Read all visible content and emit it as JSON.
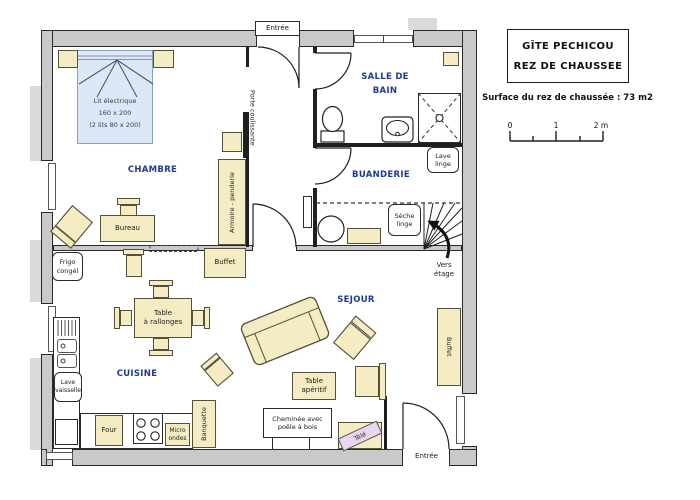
{
  "title_block": {
    "line1": "GÎTE PECHICOU",
    "line2": "REZ DE CHAUSSEE"
  },
  "surface_note": "Surface du rez de chaussée : 73 m2",
  "scale_bar": {
    "t0": "0",
    "t1": "1",
    "t2": "2 m"
  },
  "rooms": {
    "chambre": "CHAMBRE",
    "salle_de_bain": "SALLE DE\nBAIN",
    "buanderie": "BUANDERIE",
    "cuisine": "CUISINE",
    "sejour": "SEJOUR"
  },
  "openings": {
    "entree_top": "Entrée",
    "entree_bottom": "Entrée",
    "porte_coulissante": "Porte coulissante",
    "vers_etage": "Vers\nétage"
  },
  "furniture": {
    "lit": "Lit électrique\n160 x 200\n(2 lits 80 x 200)",
    "bureau": "Bureau",
    "armoire": "Armoire - penderie",
    "buffet_cuisine": "Buffet",
    "buffet_sejour": "Buffet",
    "frigo": "Frigo\ncongél",
    "table_rallonges": "Table\nà rallonges",
    "lave_vaisselle": "Lave\nvaisselle",
    "four": "Four",
    "micro_ondes": "Micro\nondes",
    "banquette": "Banquette",
    "table_aperitif": "Table\napéritif",
    "cheminee": "Cheminée avec\npoêle à bois",
    "tele": "Télé",
    "lave_linge": "Lave\nlinge",
    "seche_linge": "Sèche\nlinge"
  },
  "colors": {
    "wall_gray": "#c9c9c9",
    "wall_outer": "#dadada",
    "furniture_beige": "#f6ecc3",
    "bed_blue": "#dce8f5",
    "room_label_blue": "#1e3a96",
    "tv_lavender": "#e9d7f0"
  }
}
